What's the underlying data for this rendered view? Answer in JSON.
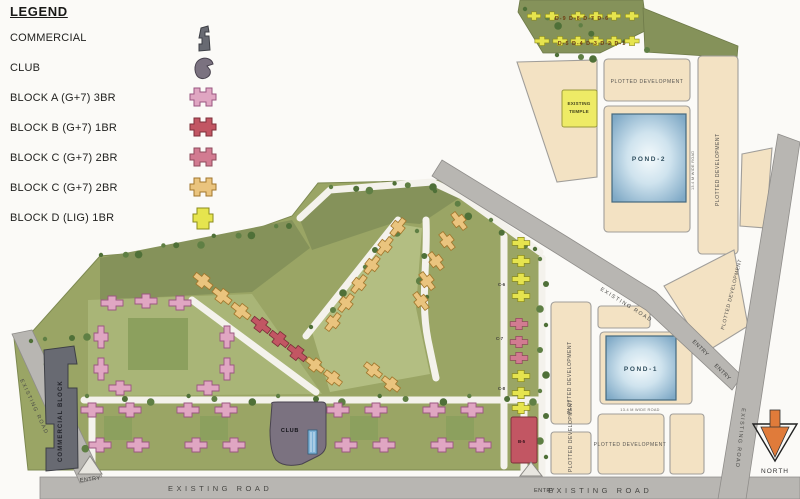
{
  "legend": {
    "title": "LEGEND",
    "items": [
      {
        "label": "COMMERCIAL",
        "icon": "commercial-icon"
      },
      {
        "label": "CLUB",
        "icon": "club-icon"
      },
      {
        "label": "BLOCK A (G+7) 3BR",
        "icon": "block-a-icon"
      },
      {
        "label": "BLOCK B (G+7) 1BR",
        "icon": "block-b-icon"
      },
      {
        "label": "BLOCK C (G+7) 2BR",
        "icon": "block-c-icon"
      },
      {
        "label": "BLOCK C (G+7) 2BR",
        "icon": "block-c-orange-icon"
      },
      {
        "label": "BLOCK D (LIG) 1BR",
        "icon": "block-d-icon"
      }
    ]
  },
  "plan": {
    "roads": {
      "existing_road": "EXISTING ROAD",
      "entry": "ENTRY",
      "wide_road": "13.4 M WIDE ROAD"
    },
    "parcels": {
      "plotted_development": "PLOTTED DEVELOPMENT",
      "temple_line1": "EXISTING",
      "temple_line2": "TEMPLE",
      "pond1": "POND-1",
      "pond2": "POND-2"
    },
    "buildings": {
      "commercial_block": "COMMERCIAL BLOCK",
      "club": "CLUB",
      "d_row_top": "D-9  D-8  D-7  D-6",
      "d_row_bottom": "D-5  D-4  D-3  D-2  D-1",
      "c6": "C-6",
      "c7": "C-7",
      "c8": "C-8",
      "b5": "B-5"
    },
    "compass": {
      "north": "NORTH"
    }
  },
  "colors": {
    "bg": "#fbfaf7",
    "road": "#b8b6b2",
    "road_edge": "#8f8d8a",
    "site_green": "#9aa565",
    "green_dark": "#85925a",
    "lawn": "#a9b577",
    "lawn_light": "#b3be82",
    "court_green": "#8ca05e",
    "tree": "#4f7038",
    "tree_light": "#5f7f44",
    "parcel": "#f3e2c3",
    "parcel_edge": "#a09e9a",
    "temple": "#eeeb66",
    "pond_deep": "#7fa9c6",
    "pond_mid": "#cfe3ee",
    "pond_light": "#f4fafc",
    "white_road": "#f4f2ec",
    "block_a": "#e0a6c2",
    "block_b": "#c25663",
    "block_c": "#d27b91",
    "block_c_orange": "#eac47e",
    "block_d": "#e6e44e",
    "commercial": "#686a72",
    "club": "#7b7280",
    "north_orange": "#e07b3a"
  }
}
